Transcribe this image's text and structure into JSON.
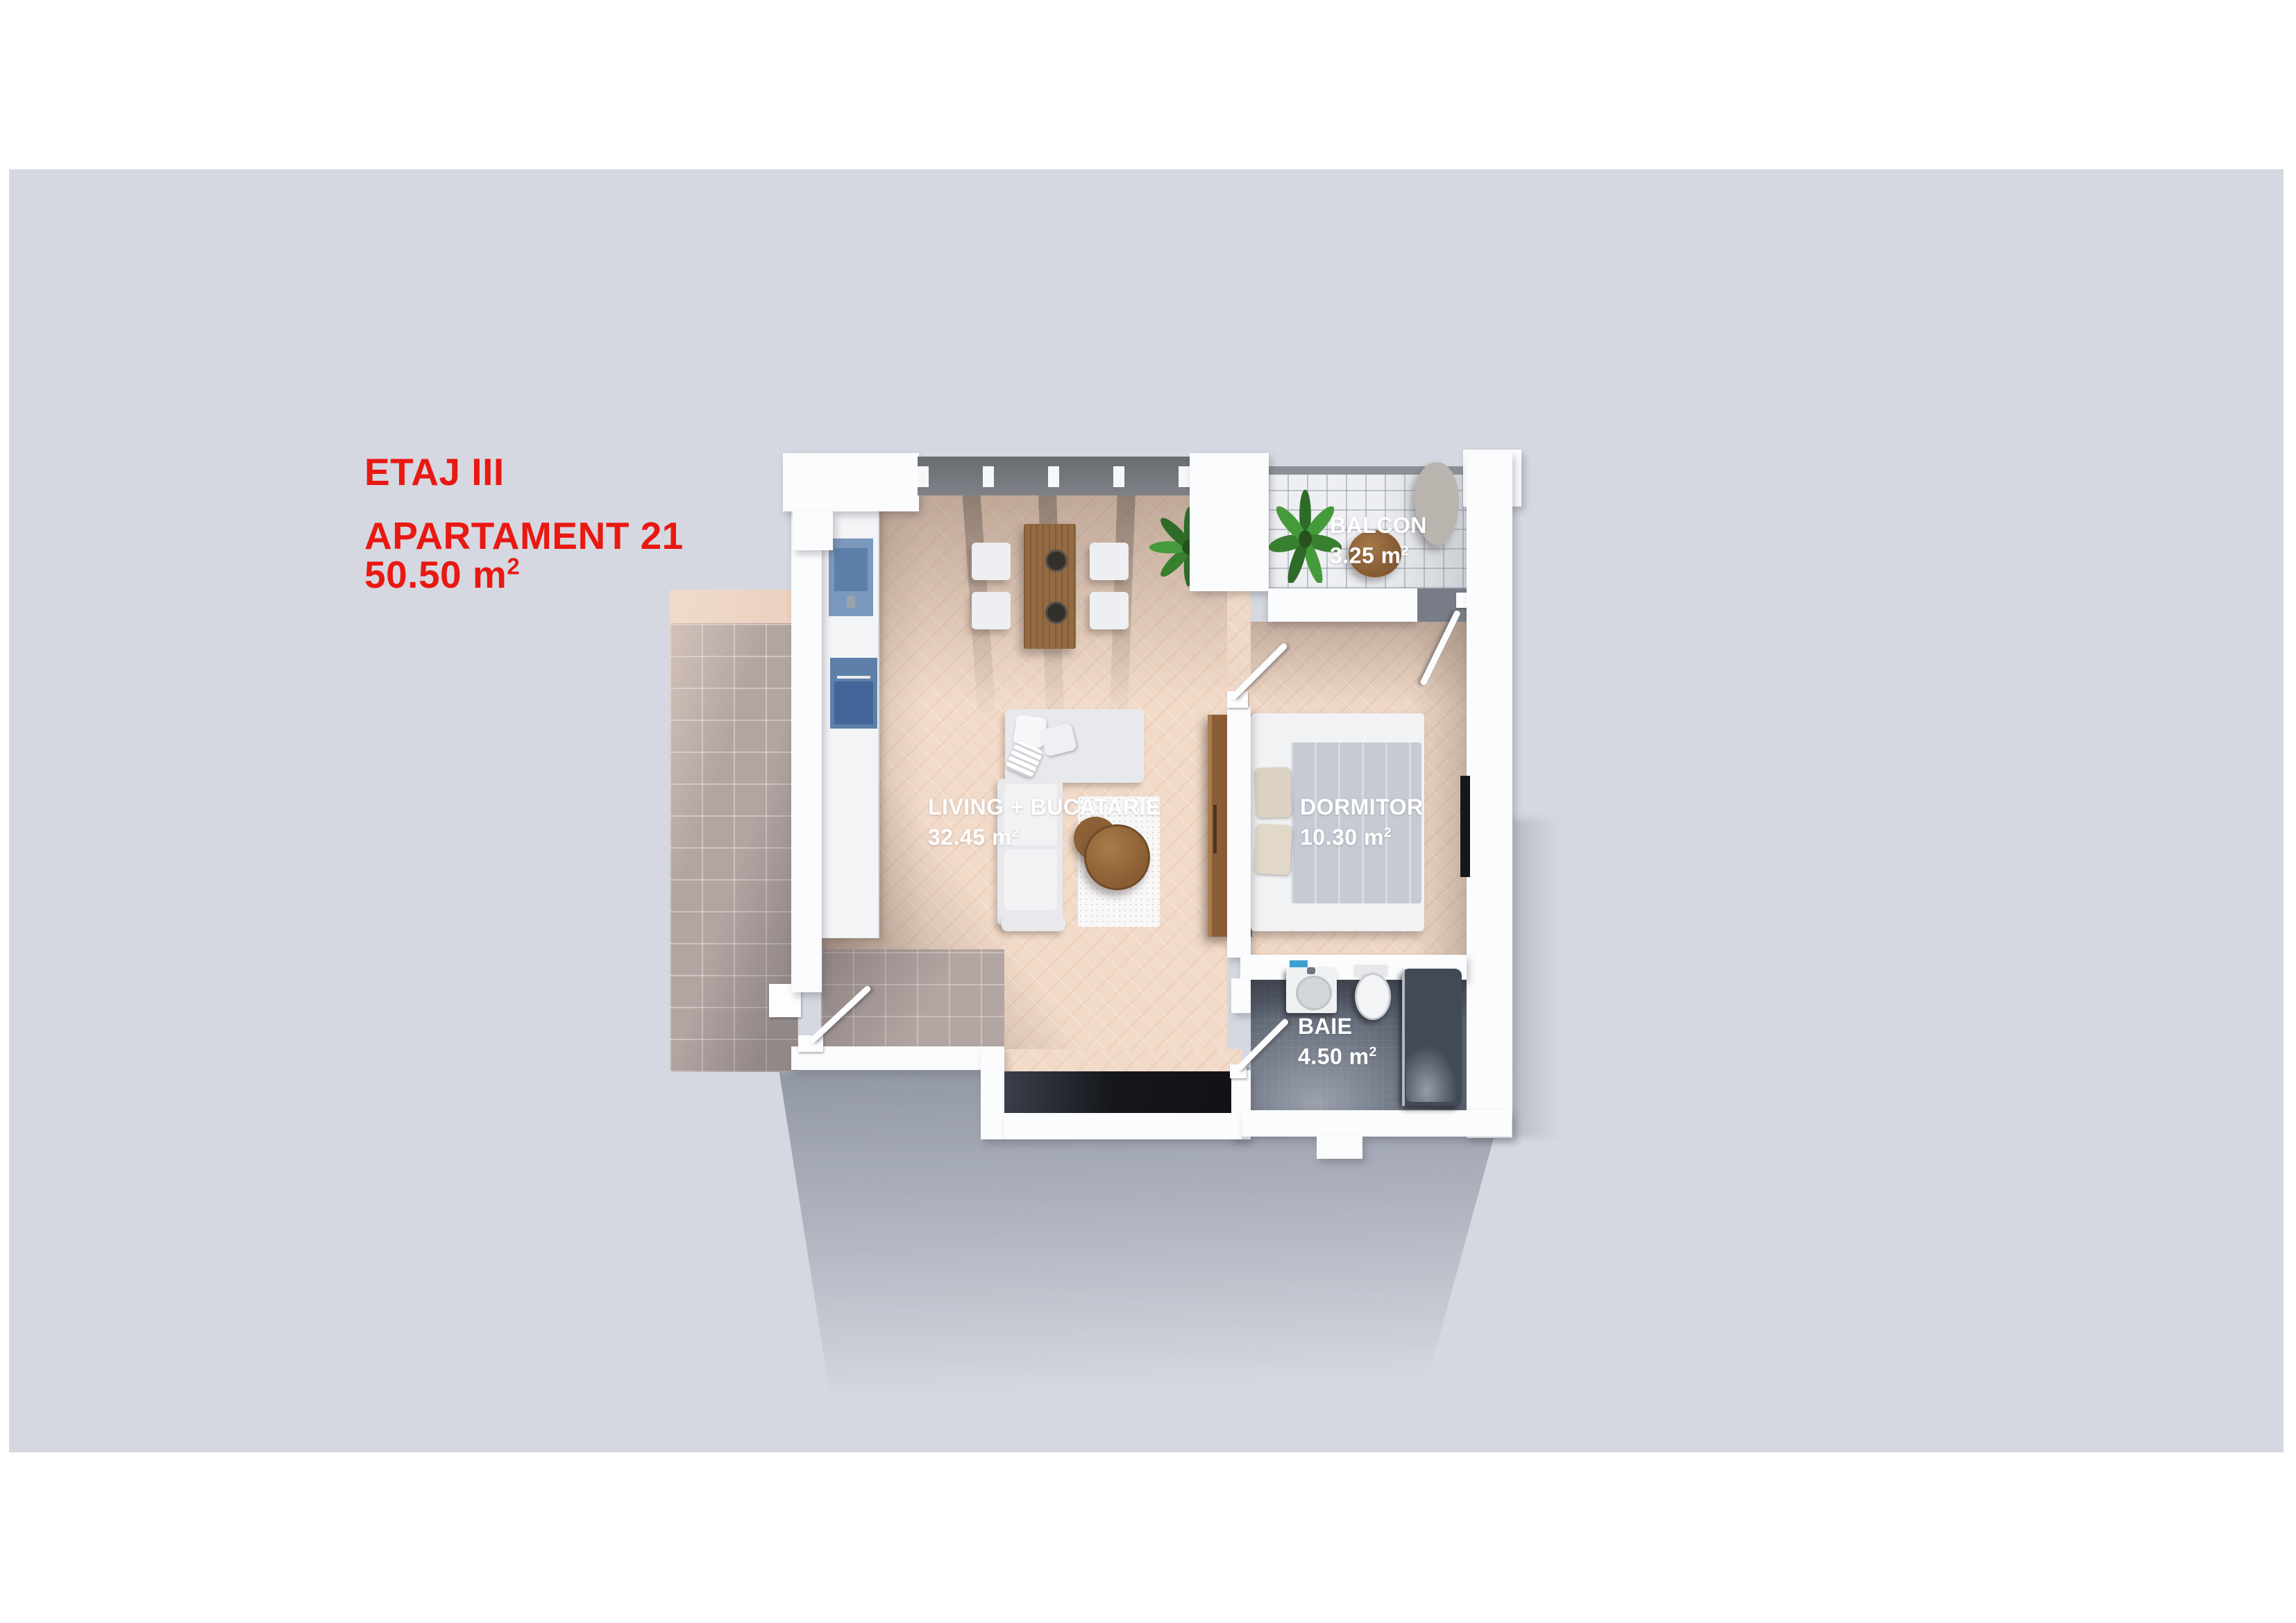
{
  "title_block": {
    "floor": "ETAJ III",
    "apartment": "APARTAMENT 21",
    "area": "50.50 m",
    "area_sup": "2"
  },
  "rooms": [
    {
      "id": "living",
      "label": "LIVING + BUCATARIE",
      "area": "32.45 m",
      "sup": "2"
    },
    {
      "id": "dormitor",
      "label": "DORMITOR",
      "area": "10.30 m",
      "sup": "2"
    },
    {
      "id": "balcon",
      "label": "BALCON",
      "area": "3.25 m",
      "sup": "2"
    },
    {
      "id": "baie",
      "label": "BAIE",
      "area": "4.50 m",
      "sup": "2"
    }
  ],
  "colors": {
    "accent_red": "#e91812",
    "backdrop_gray": "#d5d8e0",
    "wall_white": "#fbfcfe",
    "parquet": "#f2dac8",
    "terrace_tile": "#b2a4a1",
    "balcony_tile": "#edeff2",
    "bath_tile": "#58606e",
    "window_band": "#6b6e73",
    "furniture_wood": "#8f6137",
    "appliance_blue": "#5e80a8",
    "duvet_gray": "#c5cad3",
    "label_white": "#ffffff"
  }
}
